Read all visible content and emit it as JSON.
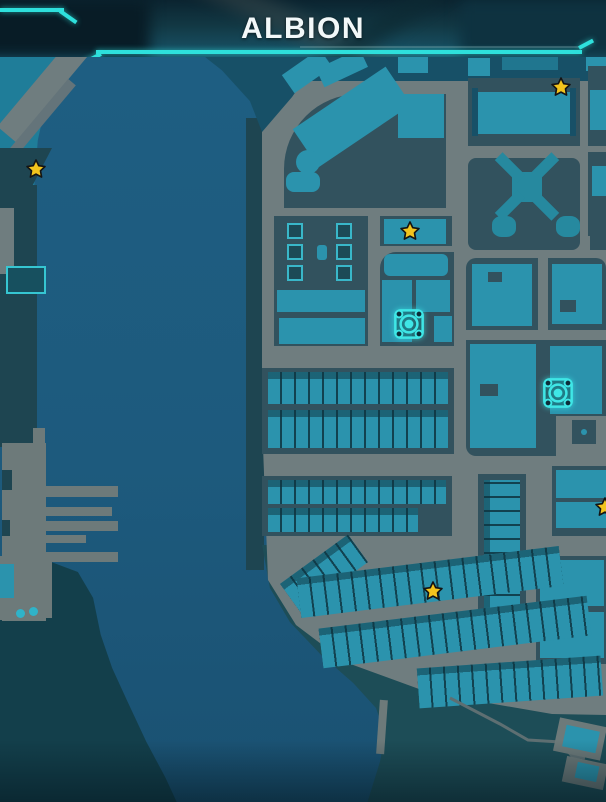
{
  "header": {
    "title": "ALBION"
  },
  "theme": {
    "accent": "#2ee0dc",
    "water": "#1d5a7d",
    "road": "#6f7d7f",
    "dock": "#6d7a7a",
    "block": "#32525e",
    "building": "#2b93ad",
    "buildingDark": "#20768f",
    "navy": "#175067",
    "tealLand": "#1f7d99",
    "landDark": "#1e4551",
    "coastDark": "#1d4d57",
    "wreck": "#133f4b",
    "starFill": "#f2c41d",
    "starStroke": "#141414",
    "icon": "#3fe6e6"
  },
  "markers": {
    "stars": [
      {
        "x": 36,
        "y": 169,
        "label": "collectible-star"
      },
      {
        "x": 410,
        "y": 231,
        "label": "collectible-star"
      },
      {
        "x": 561,
        "y": 87,
        "label": "collectible-star"
      },
      {
        "x": 433,
        "y": 591,
        "label": "collectible-star"
      },
      {
        "x": 605,
        "y": 507,
        "label": "collectible-star-partial"
      }
    ],
    "landmarks": [
      {
        "x": 409,
        "y": 324,
        "label": "surveillance-landmark"
      },
      {
        "x": 558,
        "y": 393,
        "label": "surveillance-landmark"
      }
    ],
    "boats": [
      {
        "x": 20,
        "y": 613
      },
      {
        "x": 33,
        "y": 611
      }
    ]
  }
}
